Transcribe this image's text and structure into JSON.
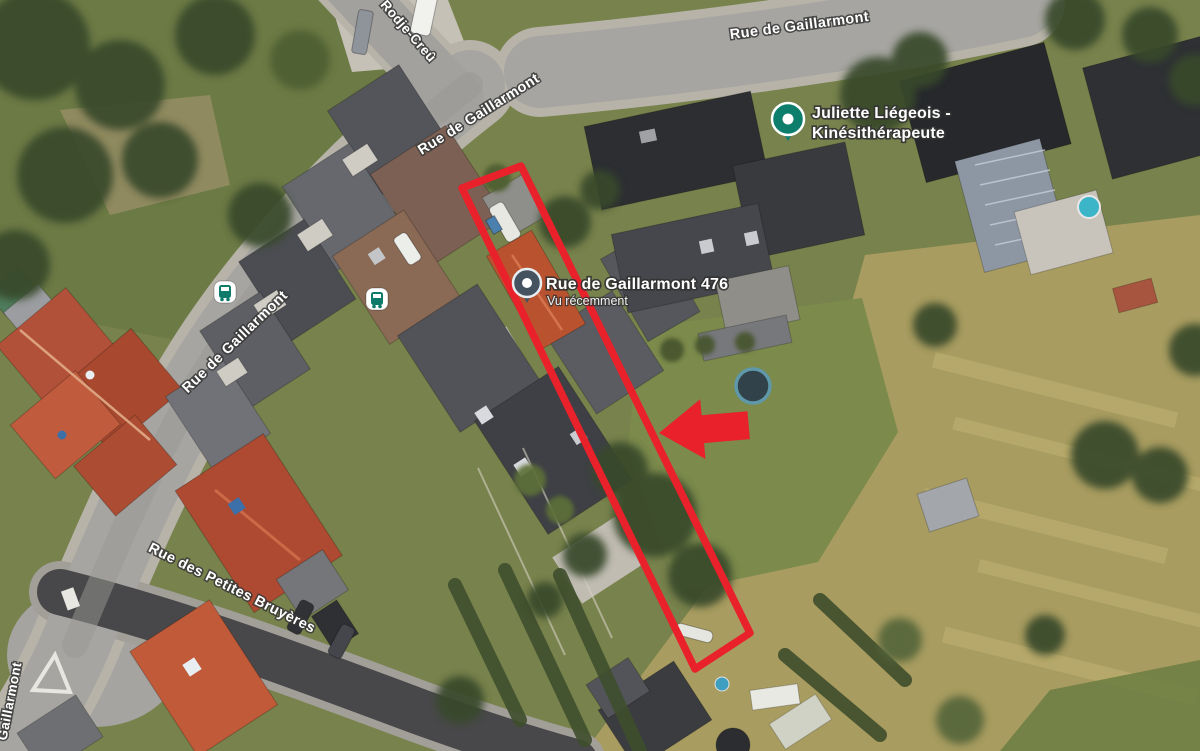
{
  "map": {
    "street_labels": [
      {
        "id": "gaillarmont-top",
        "text": "Rue de Gaillarmont"
      },
      {
        "id": "gaillarmont-mid",
        "text": "Rue de Gaillarmont"
      },
      {
        "id": "gaillarmont-left",
        "text": "Rue de Gaillarmont"
      },
      {
        "id": "gaillarmont-edge",
        "text": "Gaillarmont"
      },
      {
        "id": "rodje-creu",
        "text": "Rodje-Creû"
      },
      {
        "id": "petites-bruyeres",
        "text": "Rue des Petites Bruyères"
      }
    ],
    "markers": {
      "kine": {
        "line1": "Juliette Liégeois -",
        "line2": "Kinésithérapeute",
        "pin_color": "#0d7d6c"
      },
      "address": {
        "title": "Rue de Gaillarmont 476",
        "subtitle": "Vu récemment",
        "pin_color": "#44535f"
      }
    },
    "annotations": {
      "outline_color": "#e8212b",
      "arrow_color": "#e8212b"
    },
    "icons": {
      "bus_glyph_color": "#0d7a6a"
    }
  }
}
